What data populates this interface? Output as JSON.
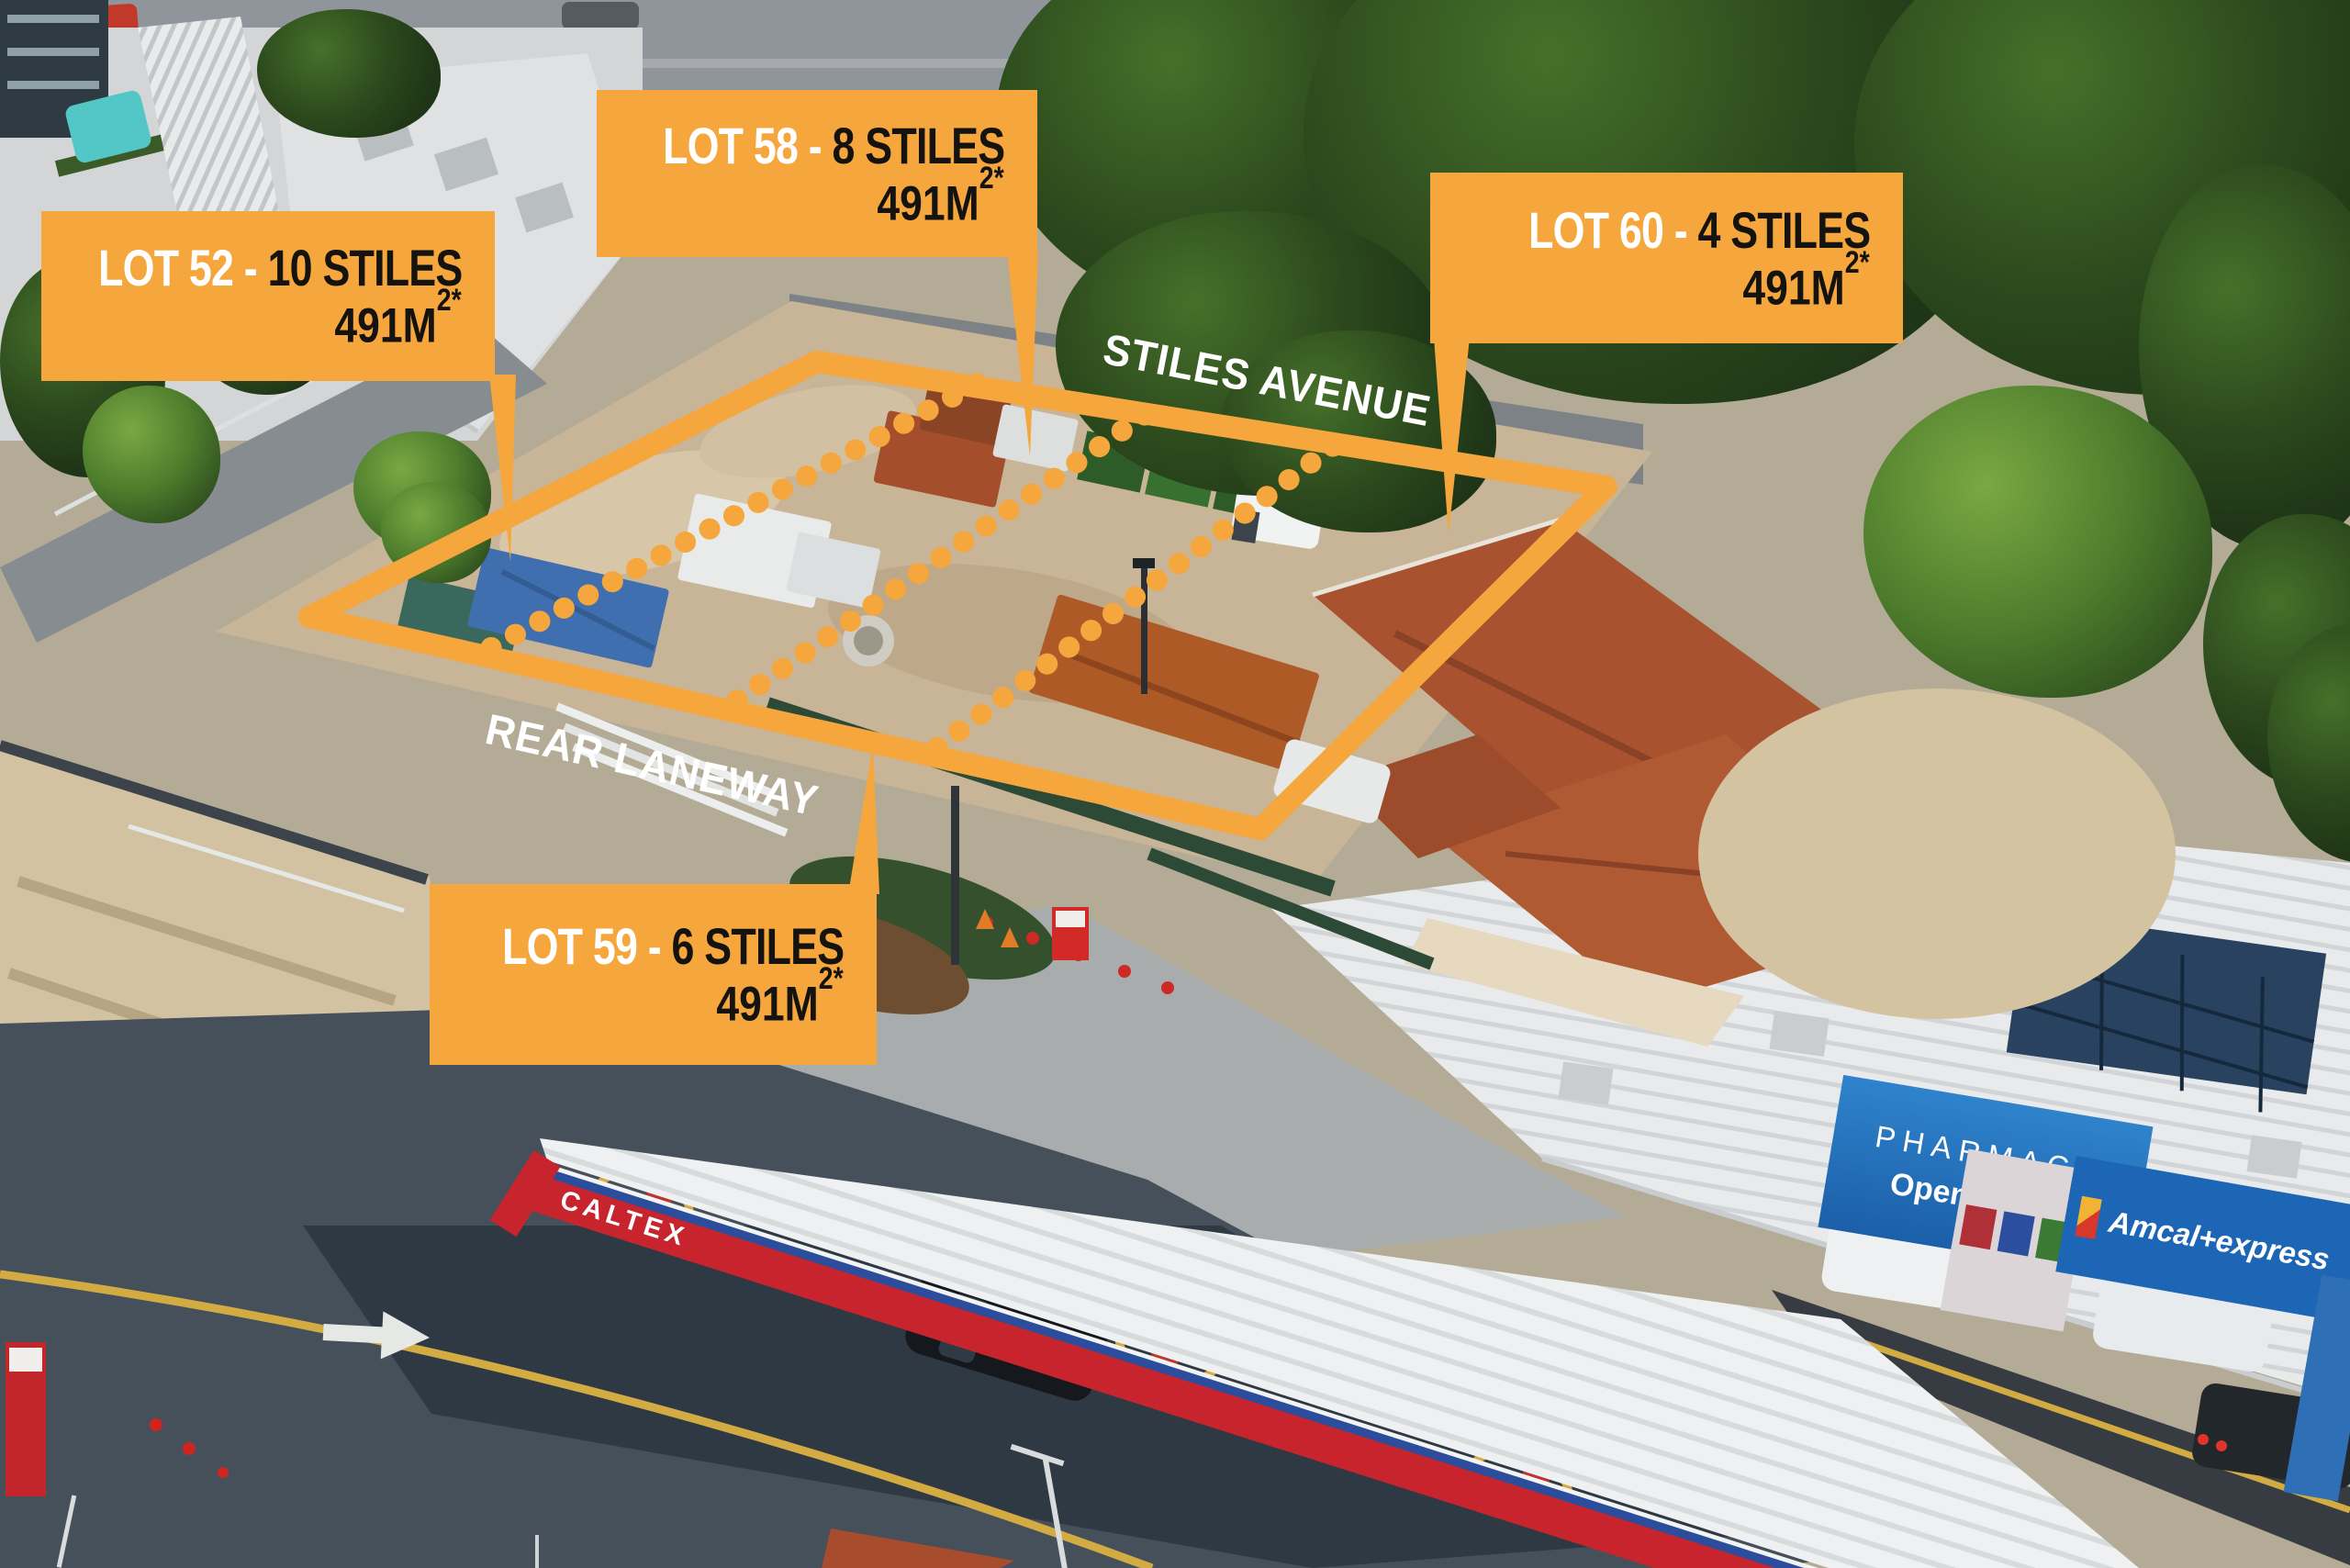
{
  "annotations": {
    "accent_color": "#F5A63C",
    "lots": [
      {
        "name": "LOT 52 - ",
        "units": "10 STILES",
        "area_value": "491M",
        "area_sup": "2*"
      },
      {
        "name": "LOT 58 - ",
        "units": "8 STILES",
        "area_value": "491M",
        "area_sup": "2*"
      },
      {
        "name": "LOT 59 - ",
        "units": "6 STILES",
        "area_value": "491M",
        "area_sup": "2*"
      },
      {
        "name": "LOT 60 - ",
        "units": "4 STILES",
        "area_value": "491M",
        "area_sup": "2*"
      }
    ],
    "streets": {
      "avenue": "STILES AVENUE",
      "laneway": "REAR LANEWAY"
    }
  },
  "scene": {
    "station": {
      "brand": "CALTEX",
      "canopy_red": "#c8242e"
    },
    "shops": {
      "pharmacy_title": "PHARMACY",
      "pharmacy_subtitle": "Open 7 days",
      "amcal": "Amcal+express"
    }
  }
}
